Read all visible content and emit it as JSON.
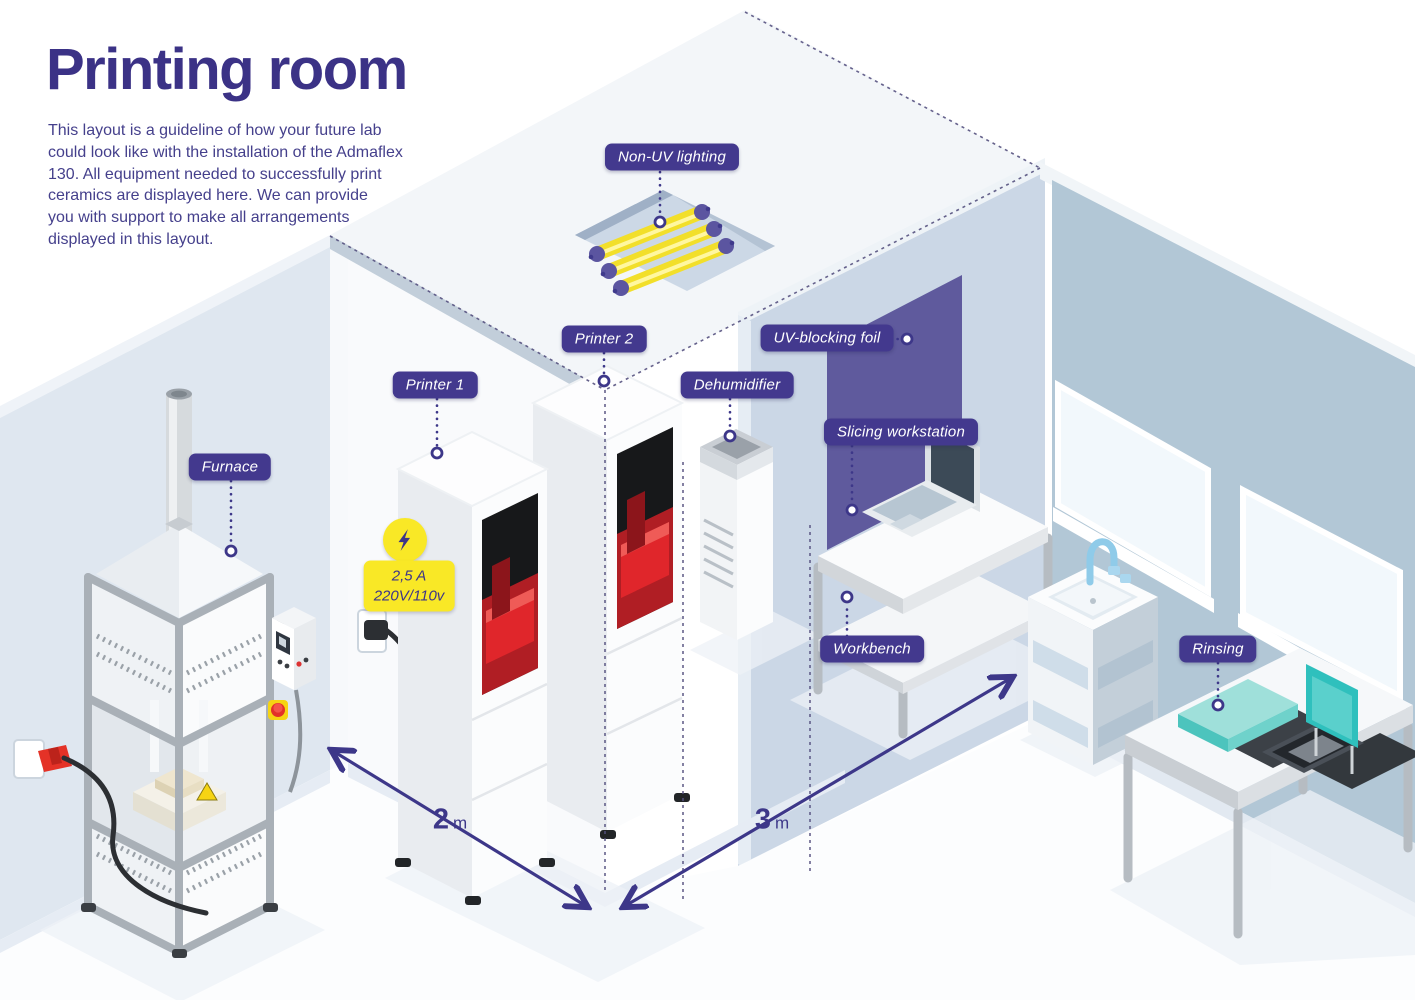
{
  "page": {
    "title": "Printing room",
    "description": "This layout is a guideline of how your future lab\ncould look like with the installation of the Admaflex\n130. All equipment needed to successfully print\nceramics are displayed here. We can provide\nyou with support to make all arrangements\ndisplayed in this layout."
  },
  "labels": {
    "non_uv_lighting": "Non-UV lighting",
    "printer_1": "Printer 1",
    "printer_2": "Printer 2",
    "dehumidifier": "Dehumidifier",
    "uv_blocking_foil": "UV-blocking foil",
    "slicing_workstation": "Slicing workstation",
    "furnace": "Furnace",
    "workbench": "Workbench",
    "rinsing": "Rinsing"
  },
  "power": {
    "amperage": "2,5 A",
    "voltage": "220V/110v"
  },
  "dimensions": {
    "room_width": {
      "value": "2",
      "unit": "m"
    },
    "room_depth": {
      "value": "3",
      "unit": "m"
    }
  },
  "colors": {
    "brand_purple": "#43398e",
    "text_purple": "#3b3286",
    "accent_yellow": "#f9e826",
    "uv_foil_purple": "#5f5a9d",
    "wall_blue": "#b2c7d6",
    "teal": "#2fc0bd",
    "machine_red": "#e0262b"
  }
}
